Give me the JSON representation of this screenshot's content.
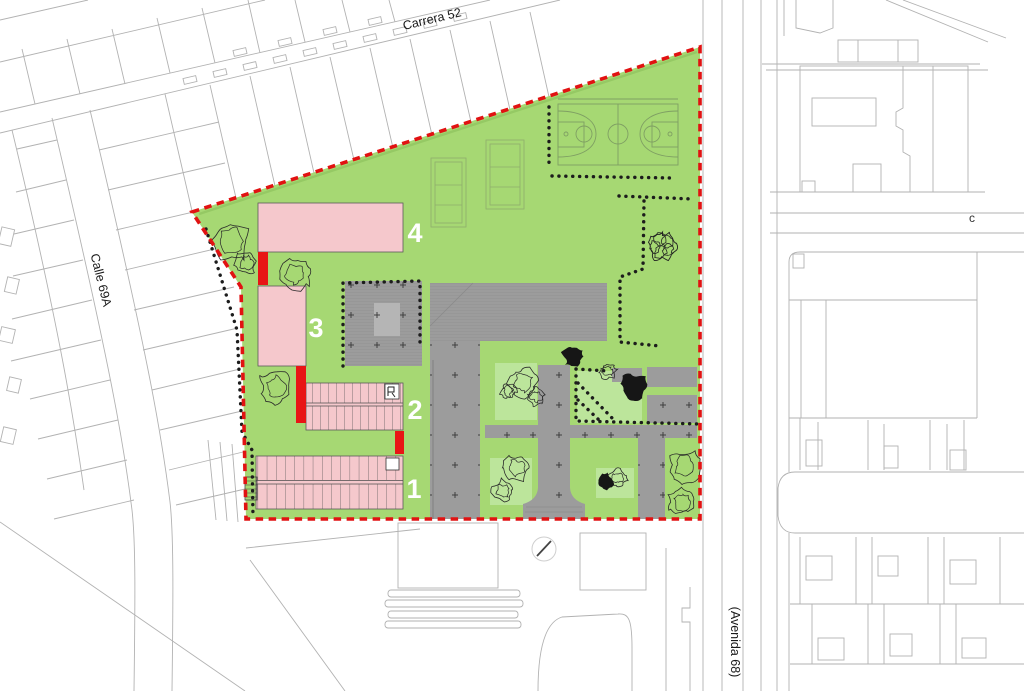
{
  "map": {
    "street_labels": {
      "top": "Carrera 52",
      "left": "Calle 69A",
      "right": "(Avenida 68)",
      "right_edge_partial": "c"
    },
    "site": {
      "building_labels": [
        "1",
        "2",
        "3",
        "4"
      ]
    },
    "colors": {
      "site_green": "#a6d873",
      "building_pink": "#f5c8cc",
      "accent_red": "#e81515",
      "paving_gray": "#9c9c9c",
      "boundary_red": "#e11212"
    }
  }
}
